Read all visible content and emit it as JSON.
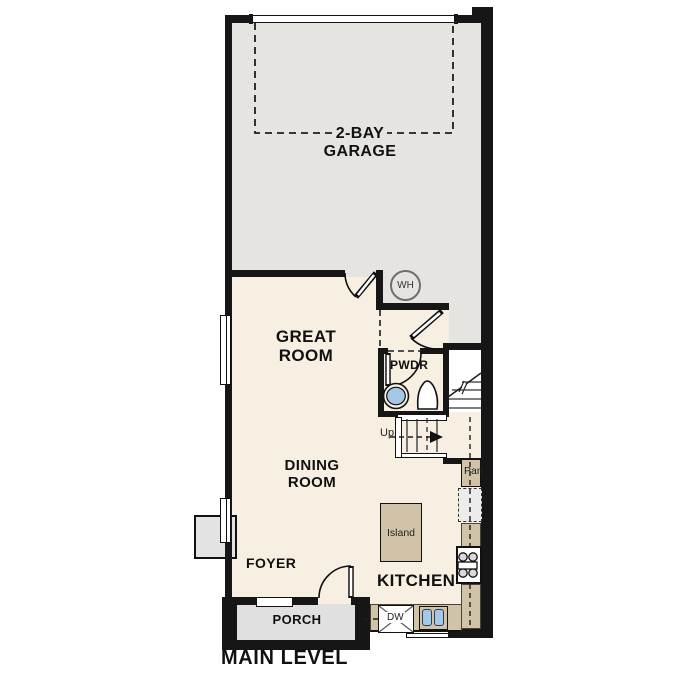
{
  "title": "MAIN LEVEL",
  "rooms": {
    "garage": {
      "line1": "2-BAY",
      "line2": "GARAGE"
    },
    "great_room": {
      "line1": "GREAT",
      "line2": "ROOM"
    },
    "dining_room": {
      "line1": "DINING",
      "line2": "ROOM"
    },
    "kitchen": {
      "label": "KITCHEN"
    },
    "foyer": {
      "label": "FOYER"
    },
    "porch": {
      "label": "PORCH"
    },
    "powder_room": {
      "label": "PWDR"
    }
  },
  "fixtures": {
    "water_heater_label": "WH",
    "dishwasher_label": "DW",
    "pantry_label": "Pan",
    "island_label": "Island",
    "stairs_direction_label": "Up"
  },
  "colors": {
    "wall": "#161616",
    "garage_floor": "#e5e4e1",
    "house_floor": "#f7f0e2",
    "counter": "#d0c3a8",
    "porch_floor": "#e0e0e0",
    "appliance_blue": "#a6c8e6",
    "fridge_gray": "#ececec"
  }
}
